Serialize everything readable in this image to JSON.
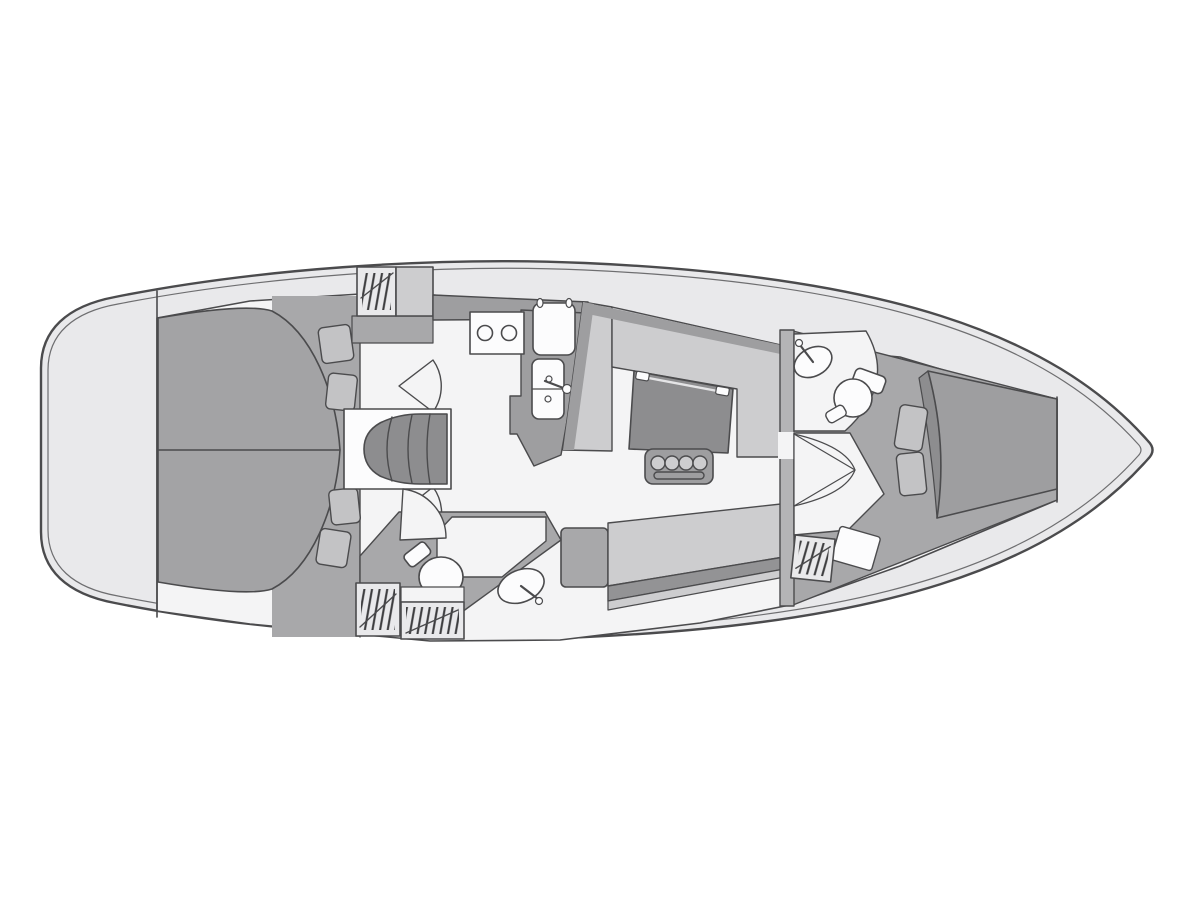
{
  "palette": {
    "background": "#ffffff",
    "deck": "#e9e9eb",
    "floor": "#f4f4f5",
    "wall": "#a8a8aa",
    "counter": "#9e9ea0",
    "cushion": "#cdcdcf",
    "cushion_dark": "#939395",
    "furniture_dark": "#8d8d8f",
    "berth": "#9e9ea0",
    "berth_aft": "#a3a3a5",
    "pillow": "#c3c3c5",
    "fixture": "#fcfcfd",
    "bulkhead": "#b4b4b6",
    "outline": "#4b4b4d",
    "line_soft": "#6e6e70",
    "hatch": "#3c3c3e"
  },
  "plan": {
    "type": "sailboat-interior-floorplan",
    "orientation": {
      "bow": "right",
      "stern": "left"
    },
    "regions": [
      {
        "id": "stern-deck",
        "name": "stern deck"
      },
      {
        "id": "aft-cabin-port",
        "name": "aft double cabin (upper)"
      },
      {
        "id": "aft-cabin-starboard",
        "name": "aft double cabin (lower)"
      },
      {
        "id": "companionway-steps",
        "name": "companionway steps"
      },
      {
        "id": "galley",
        "name": "galley"
      },
      {
        "id": "salon",
        "name": "salon with U-settee and table"
      },
      {
        "id": "aft-head",
        "name": "aft head with toilet and washbasin"
      },
      {
        "id": "forward-head",
        "name": "forward head with toilet and washbasin"
      },
      {
        "id": "forward-cabin",
        "name": "forward V-berth cabin"
      },
      {
        "id": "bow-deck",
        "name": "bow deck"
      }
    ],
    "fixtures": [
      "aft-double-berth",
      "pillow",
      "hanging-locker",
      "stove-two-burner",
      "fridge-icebox",
      "galley-double-sink",
      "faucet",
      "u-settee",
      "salon-table",
      "bottle-holder",
      "bench-settee",
      "toilet",
      "washbasin",
      "door-swing",
      "v-berth-mattress"
    ]
  }
}
